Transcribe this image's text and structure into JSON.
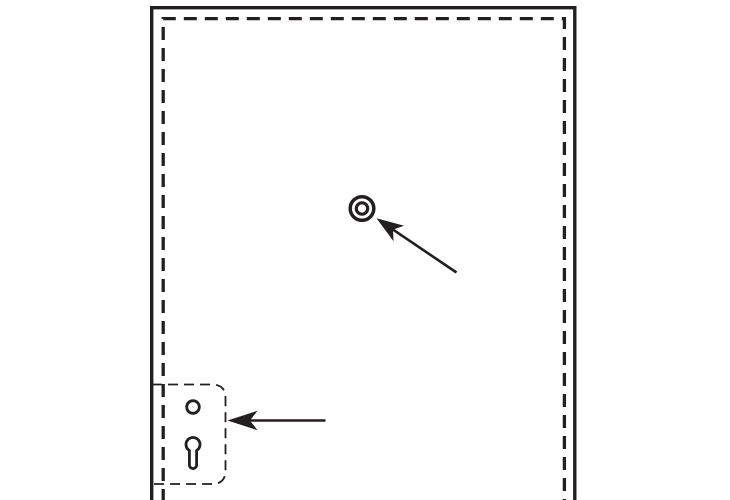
{
  "canvas": {
    "background": "#ffffff",
    "ink": "#231f20"
  },
  "diagram": {
    "kind": "monochrome technical line illustration",
    "panel": {
      "label": "panel",
      "outer_edge_style": "solid",
      "inner_edge_style": "dashed",
      "bottom_edge": "cut off by image border"
    },
    "mounting_hole": {
      "label": "mounting-hole",
      "shape": "double concentric circle"
    },
    "keyhole_plate": {
      "label": "keyhole-mounting-plate",
      "outline_style": "thin dashed rounded rectangle",
      "holes": [
        "round pilot hole",
        "keyhole slot"
      ]
    },
    "arrows": [
      {
        "label": "arrow-to-mounting-hole",
        "direction": "points up-left at the double circle"
      },
      {
        "label": "arrow-to-keyhole-plate",
        "direction": "points left at the keyhole plate"
      }
    ]
  }
}
